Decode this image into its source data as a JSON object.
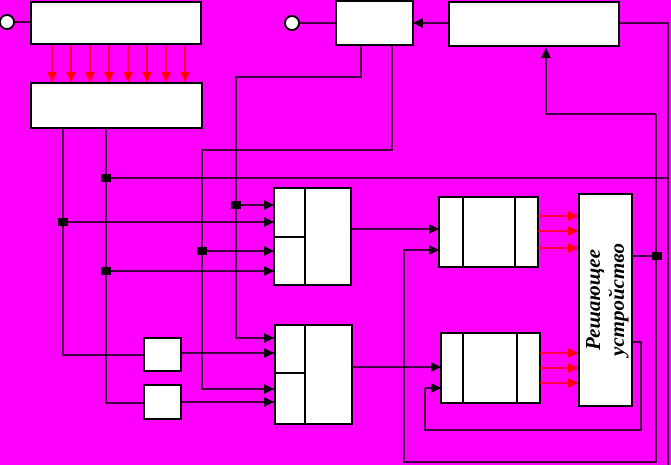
{
  "diagram": {
    "canvas": {
      "w": 671,
      "h": 465
    },
    "background": "#FF00FF",
    "box_fill": "#FFFFFF",
    "line_color": "#000000",
    "signal_color": "#FF0000",
    "label": {
      "line1": "Решающее",
      "line2": "устройство"
    },
    "decider_box_geometry": {
      "x": 579,
      "y": 194,
      "w": 53,
      "h": 212
    },
    "circles": [
      {
        "cx": 7,
        "cy": 22,
        "r": 7
      },
      {
        "cx": 292,
        "cy": 23,
        "r": 7
      }
    ],
    "boxes": [
      {
        "name": "box-top-left-upper",
        "x": 31,
        "y": 2,
        "w": 170,
        "h": 42,
        "inner": []
      },
      {
        "name": "box-top-left-lower",
        "x": 31,
        "y": 83,
        "w": 171,
        "h": 45,
        "inner": []
      },
      {
        "name": "box-top-middle",
        "x": 336,
        "y": 1,
        "w": 77,
        "h": 44,
        "inner": []
      },
      {
        "name": "box-top-right",
        "x": 449,
        "y": 2,
        "w": 170,
        "h": 44,
        "inner": []
      },
      {
        "name": "box-mid-left",
        "x": 274,
        "y": 188,
        "w": 77,
        "h": 97,
        "inner": [
          [
            305,
            188,
            305,
            285
          ],
          [
            274,
            237,
            305,
            237
          ]
        ]
      },
      {
        "name": "box-lower-left",
        "x": 275,
        "y": 325,
        "w": 77,
        "h": 99,
        "inner": [
          [
            305,
            325,
            305,
            424
          ],
          [
            275,
            373,
            305,
            373
          ]
        ]
      },
      {
        "name": "box-mid-right",
        "x": 439,
        "y": 197,
        "w": 99,
        "h": 70,
        "inner": [
          [
            463,
            197,
            463,
            267
          ],
          [
            515,
            197,
            515,
            267
          ]
        ]
      },
      {
        "name": "box-lower-right",
        "x": 441,
        "y": 333,
        "w": 99,
        "h": 70,
        "inner": [
          [
            463,
            333,
            463,
            403
          ],
          [
            517,
            333,
            517,
            403
          ]
        ]
      },
      {
        "name": "box-small-a",
        "x": 144,
        "y": 338,
        "w": 37,
        "h": 33,
        "inner": []
      },
      {
        "name": "box-small-b",
        "x": 144,
        "y": 385,
        "w": 37,
        "h": 34,
        "inner": []
      },
      {
        "name": "box-decider",
        "x": 579,
        "y": 194,
        "w": 53,
        "h": 212,
        "inner": []
      }
    ],
    "polylines": [
      [
        [
          14,
          22
        ],
        [
          31,
          22
        ]
      ],
      [
        [
          299,
          23
        ],
        [
          336,
          23
        ]
      ],
      [
        [
          619,
          23
        ],
        [
          668,
          23
        ],
        [
          668,
          465
        ]
      ],
      [
        [
          106,
          178
        ],
        [
          668,
          178
        ]
      ],
      [
        [
          106,
          128
        ],
        [
          106,
          403
        ],
        [
          144,
          403
        ]
      ],
      [
        [
          63,
          128
        ],
        [
          63,
          355
        ],
        [
          144,
          355
        ]
      ],
      [
        [
          361,
          45
        ],
        [
          361,
          77
        ],
        [
          236,
          77
        ],
        [
          236,
          338
        ]
      ],
      [
        [
          392,
          45
        ],
        [
          392,
          150
        ],
        [
          202,
          150
        ],
        [
          202,
          389
        ]
      ],
      [
        [
          656,
          114
        ],
        [
          546,
          114
        ]
      ],
      [
        [
          656,
          114
        ],
        [
          656,
          462
        ],
        [
          404,
          462
        ],
        [
          404,
          250
        ]
      ],
      [
        [
          632,
          256
        ],
        [
          657,
          256
        ]
      ],
      [
        [
          632,
          342
        ],
        [
          641,
          342
        ],
        [
          641,
          430
        ],
        [
          425,
          430
        ],
        [
          425,
          388
        ]
      ]
    ],
    "arrows": [
      {
        "color": "black",
        "points": [
          [
            449,
            23
          ],
          [
            413,
            23
          ]
        ]
      },
      {
        "color": "black",
        "points": [
          [
            236,
            205
          ],
          [
            274,
            205
          ]
        ]
      },
      {
        "color": "black",
        "points": [
          [
            63,
            222
          ],
          [
            274,
            222
          ]
        ]
      },
      {
        "color": "black",
        "points": [
          [
            202,
            251
          ],
          [
            274,
            251
          ]
        ]
      },
      {
        "color": "black",
        "points": [
          [
            106,
            271
          ],
          [
            274,
            271
          ]
        ]
      },
      {
        "color": "black",
        "points": [
          [
            236,
            338
          ],
          [
            274,
            338
          ]
        ]
      },
      {
        "color": "black",
        "points": [
          [
            181,
            353
          ],
          [
            274,
            353
          ]
        ]
      },
      {
        "color": "black",
        "points": [
          [
            202,
            389
          ],
          [
            274,
            389
          ]
        ]
      },
      {
        "color": "black",
        "points": [
          [
            181,
            402
          ],
          [
            274,
            402
          ]
        ]
      },
      {
        "color": "black",
        "points": [
          [
            351,
            229
          ],
          [
            439,
            229
          ]
        ]
      },
      {
        "color": "black",
        "points": [
          [
            404,
            250
          ],
          [
            439,
            250
          ]
        ]
      },
      {
        "color": "black",
        "points": [
          [
            546,
            114
          ],
          [
            546,
            48
          ]
        ]
      },
      {
        "color": "black",
        "points": [
          [
            352,
            367
          ],
          [
            441,
            367
          ]
        ]
      },
      {
        "color": "black",
        "points": [
          [
            425,
            388
          ],
          [
            441,
            388
          ]
        ]
      },
      {
        "color": "red",
        "points": [
          [
            52,
            45
          ],
          [
            52,
            82
          ]
        ]
      },
      {
        "color": "red",
        "points": [
          [
            71,
            45
          ],
          [
            71,
            82
          ]
        ]
      },
      {
        "color": "red",
        "points": [
          [
            90,
            45
          ],
          [
            90,
            82
          ]
        ]
      },
      {
        "color": "red",
        "points": [
          [
            109,
            45
          ],
          [
            109,
            82
          ]
        ]
      },
      {
        "color": "red",
        "points": [
          [
            128,
            45
          ],
          [
            128,
            82
          ]
        ]
      },
      {
        "color": "red",
        "points": [
          [
            147,
            45
          ],
          [
            147,
            82
          ]
        ]
      },
      {
        "color": "red",
        "points": [
          [
            166,
            45
          ],
          [
            166,
            82
          ]
        ]
      },
      {
        "color": "red",
        "points": [
          [
            185,
            45
          ],
          [
            185,
            82
          ]
        ]
      },
      {
        "color": "red",
        "points": [
          [
            538,
            216
          ],
          [
            578,
            216
          ]
        ]
      },
      {
        "color": "red",
        "points": [
          [
            538,
            231
          ],
          [
            578,
            231
          ]
        ]
      },
      {
        "color": "red",
        "points": [
          [
            538,
            248
          ],
          [
            578,
            248
          ]
        ]
      },
      {
        "color": "red",
        "points": [
          [
            540,
            353
          ],
          [
            578,
            353
          ]
        ]
      },
      {
        "color": "red",
        "points": [
          [
            540,
            368
          ],
          [
            578,
            368
          ]
        ]
      },
      {
        "color": "red",
        "points": [
          [
            540,
            383
          ],
          [
            578,
            383
          ]
        ]
      }
    ],
    "junctions": [
      [
        236,
        205
      ],
      [
        63,
        222
      ],
      [
        202,
        251
      ],
      [
        106,
        271
      ],
      [
        106,
        178
      ],
      [
        657,
        256
      ]
    ]
  }
}
